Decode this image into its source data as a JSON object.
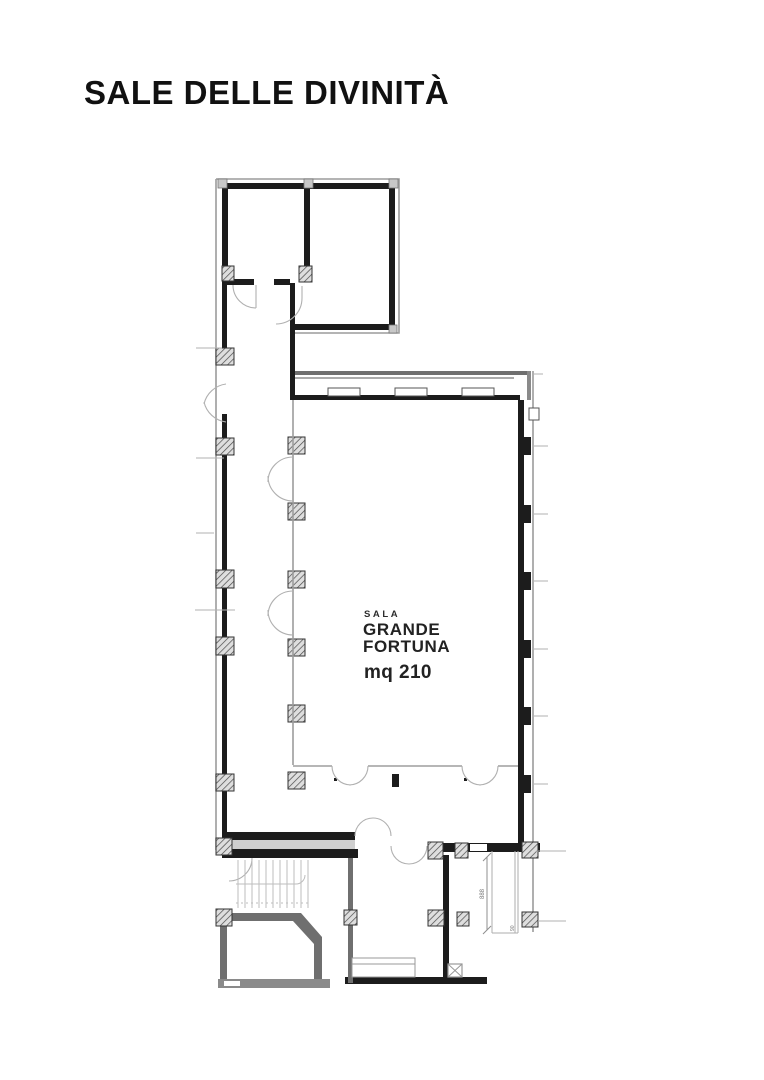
{
  "page": {
    "title": "SALE DELLE DIVINITÀ"
  },
  "floor_plan": {
    "room": {
      "label_small": "SALA",
      "label_line1": "GRANDE",
      "label_line2": "FORTUNA",
      "area_label": "mq 210"
    },
    "dimensions": {
      "shaft_height": "888",
      "shaft_width": "90"
    },
    "colors": {
      "wall_dark": "#1c1c1c",
      "wall_gray": "#6f6f6f",
      "outline_gray": "#9b9b9b",
      "door_gray": "#b0b0b0",
      "hatch_stroke": "#4a4a4a"
    }
  }
}
